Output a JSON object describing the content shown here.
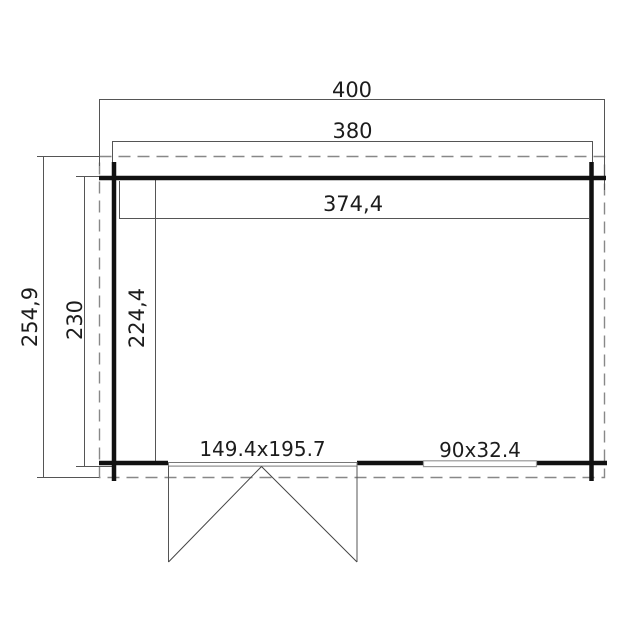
{
  "plan": {
    "type": "floor-plan",
    "units": "cm",
    "labels": {
      "roof_width": "400",
      "outer_width": "380",
      "interior_width": "374,4",
      "roof_depth": "254,9",
      "outer_depth": "230",
      "interior_depth": "224,4",
      "door_size": "149.4x195.7",
      "window_size": "90x32.4"
    },
    "colors": {
      "background": "#ffffff",
      "wall": "#111111",
      "dimension_line": "#555555",
      "roof_outline_dashed": "#888888",
      "text": "#1c1c1c"
    }
  }
}
